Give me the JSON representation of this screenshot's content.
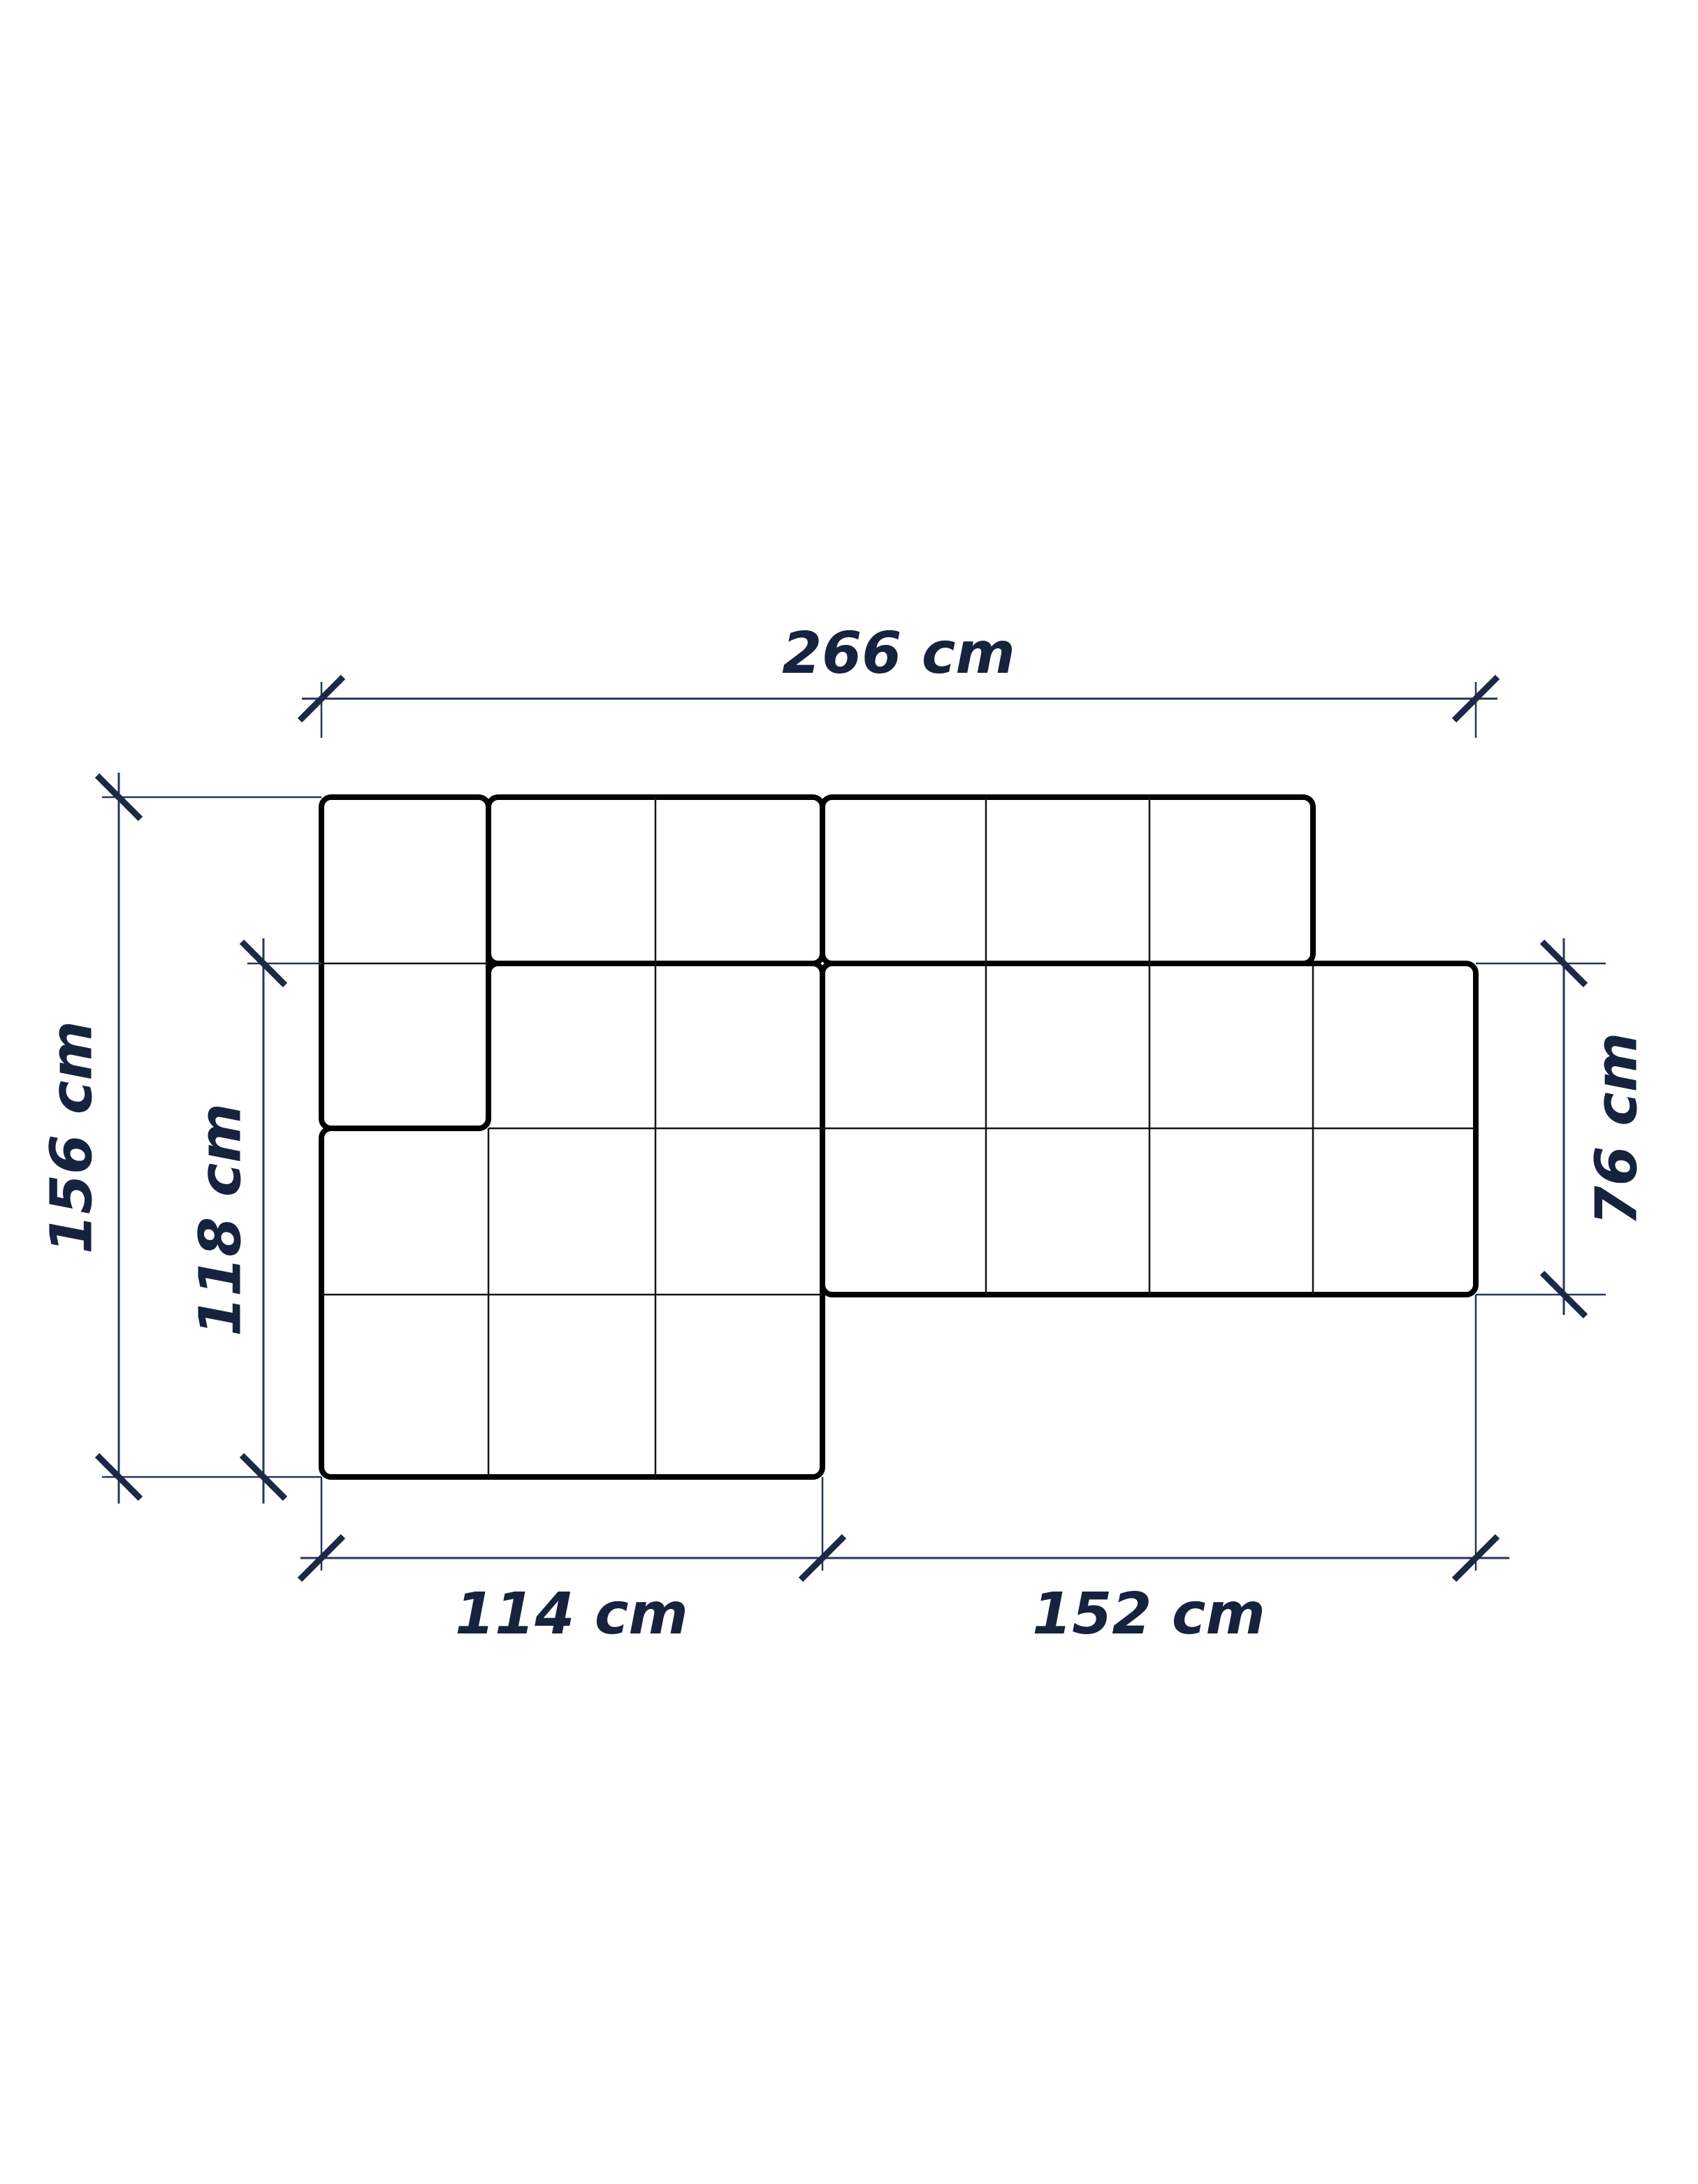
{
  "diagram": {
    "type": "technical-drawing",
    "view": "top-view-floor-plan",
    "unit": "cm",
    "colors": {
      "outline": "#000000",
      "grid": "#141414",
      "dimension": "#24365c",
      "tick": "#1b2946",
      "label": "#16233f",
      "background": "#ffffff"
    },
    "dimensions": {
      "top": {
        "label": "266 cm",
        "value_cm": 266,
        "orientation": "horizontal"
      },
      "left": {
        "label": "156 cm",
        "value_cm": 156,
        "orientation": "vertical"
      },
      "left_inner": {
        "label": "118 cm",
        "value_cm": 118,
        "orientation": "vertical"
      },
      "right": {
        "label": "76 cm",
        "value_cm": 76,
        "orientation": "vertical"
      },
      "bottom_left": {
        "label": "114 cm",
        "value_cm": 114,
        "orientation": "horizontal"
      },
      "bottom_right": {
        "label": "152 cm",
        "value_cm": 152,
        "orientation": "horizontal"
      }
    }
  }
}
